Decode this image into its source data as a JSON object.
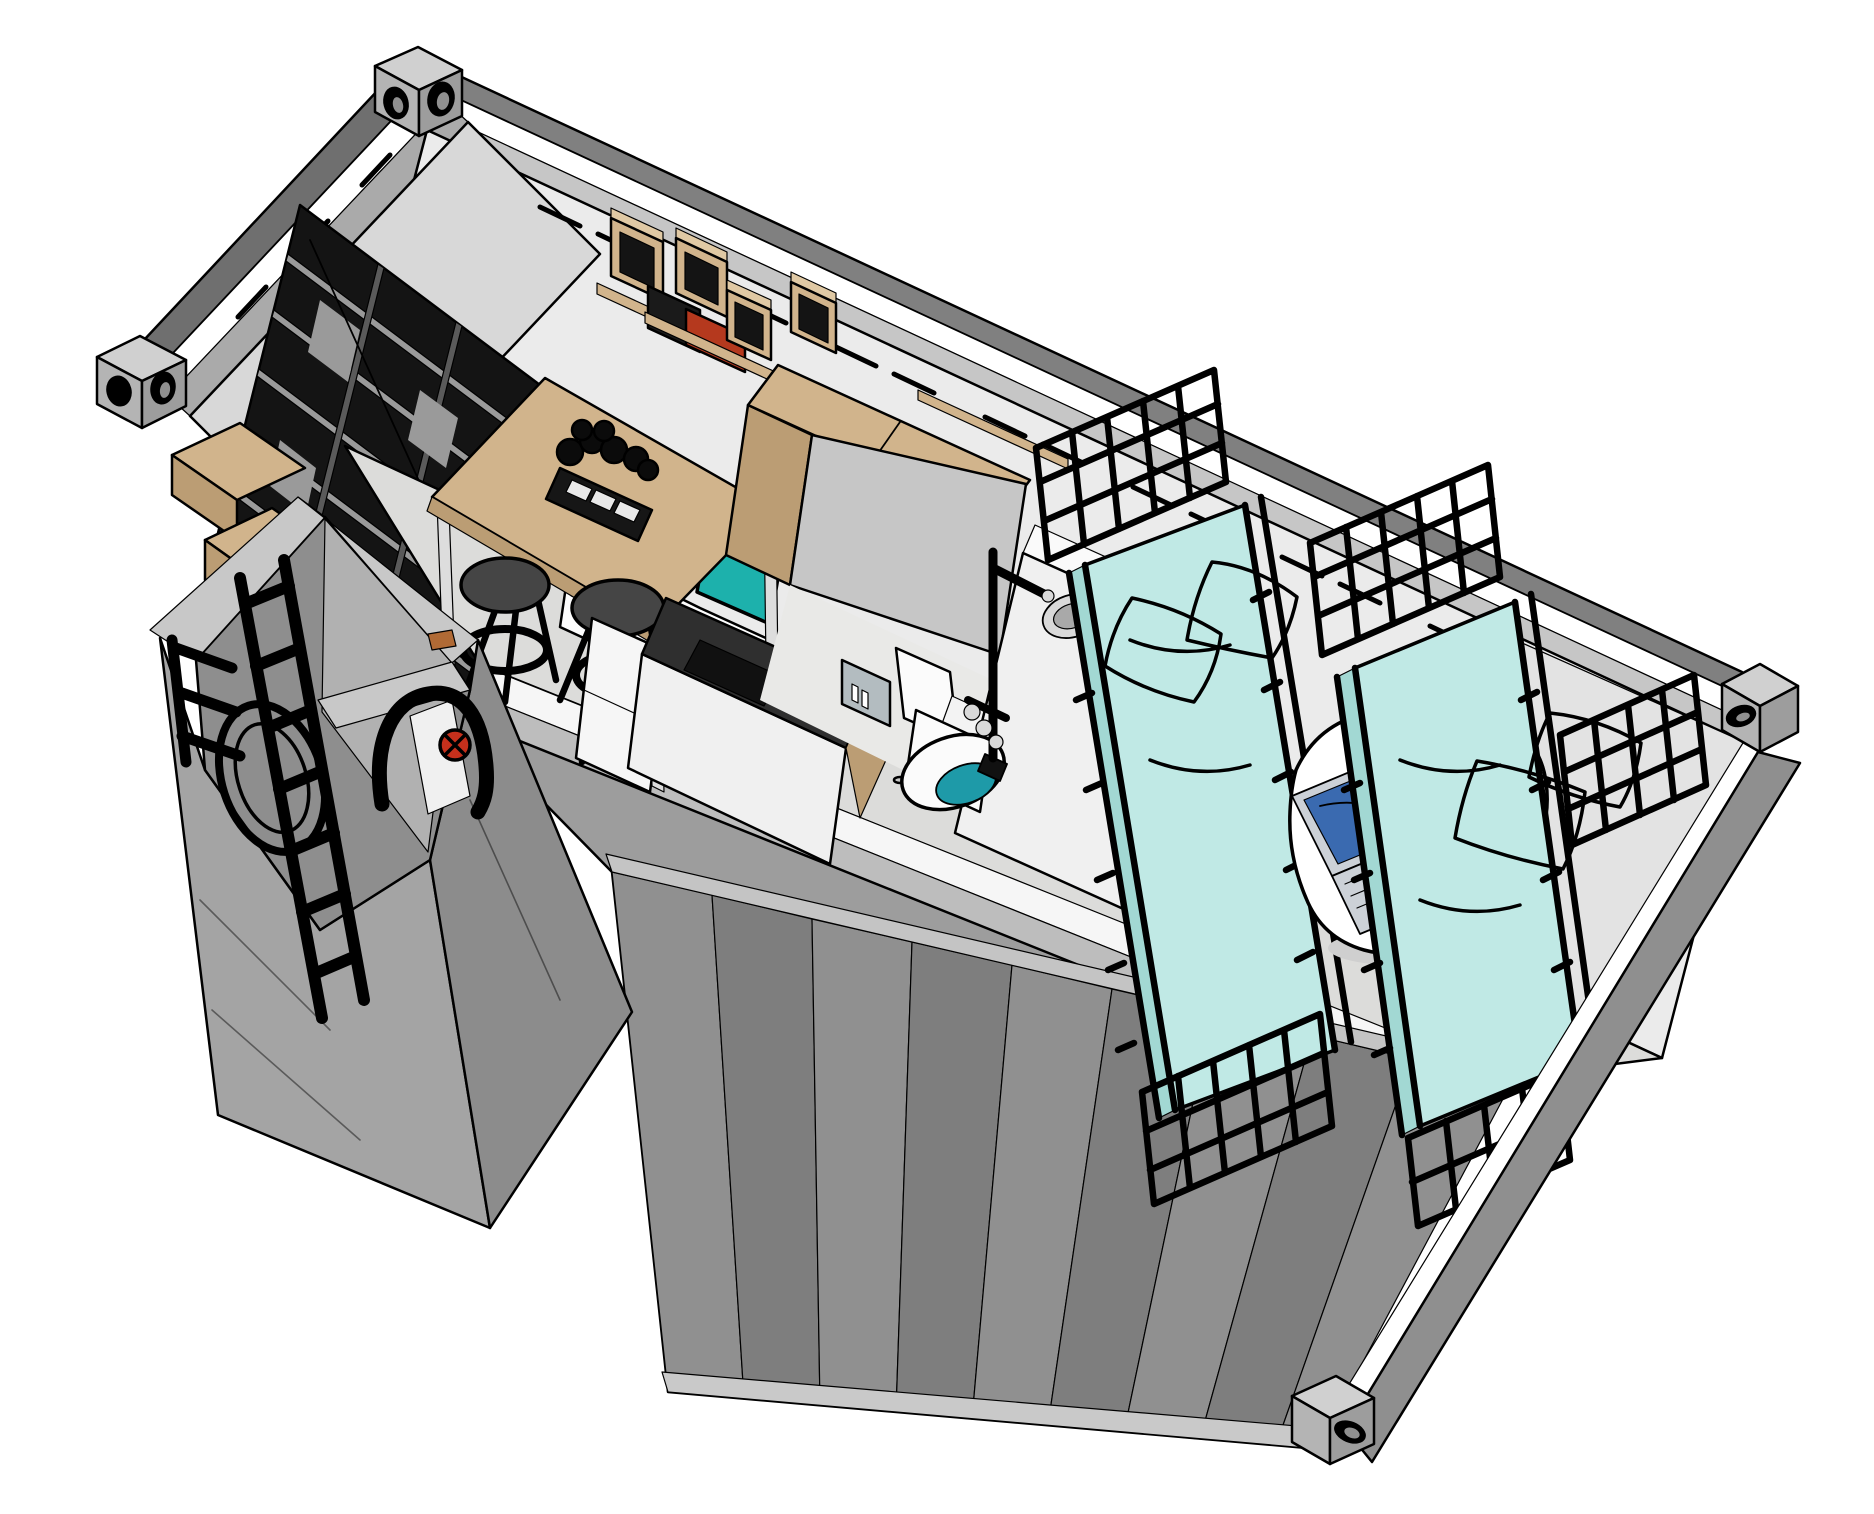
{
  "scene": {
    "type": "3d-isometric-cutaway-render",
    "subject": "shipping-container-tiny-house",
    "rooms": [
      {
        "name": "living-dining"
      },
      {
        "name": "kitchen"
      },
      {
        "name": "bathroom"
      },
      {
        "name": "bedroom"
      },
      {
        "name": "entry-vestibule"
      }
    ],
    "items": [
      "corner-castings",
      "top-rails",
      "vent-slots",
      "black-bookshelf",
      "wall-cube-shelves",
      "wall-shelf-with-books",
      "bench-sofa",
      "teal-throw-pillows",
      "bar-table",
      "planter-centerpiece",
      "bar-stools",
      "kitchen-counter",
      "refrigerator",
      "wooden-wardrobe-cabinet",
      "shower-set",
      "shower-head",
      "mirror-with-toiletries",
      "wall-shelf",
      "toilet",
      "floor-drain",
      "partition-wall",
      "metal-frame-bed-left",
      "metal-frame-bed-right",
      "bed-pillows",
      "white-desk",
      "laptop",
      "black-webcam",
      "entry-vestibule-shaft",
      "access-ladder",
      "hatch-door-frame",
      "red-valve-wheel",
      "entry-wood-shelf",
      "corrugated-side-wall",
      "concrete-floor"
    ]
  },
  "colors": {
    "bg": "#ffffff",
    "ink": "#000000",
    "rail_dark": "#808080",
    "rail_side": "#6f6f6f",
    "white": "#ffffff",
    "chamfer_far": "#c6c6c6",
    "chamfer_left": "#aaaaaa",
    "wall_far": "#ebebeb",
    "wall_left": "#d8d8d8",
    "floor": "#dcdcda",
    "floor_speck": "#c8c8c6",
    "floor_bath": "#e9e9e7",
    "band_white": "#f6f6f6",
    "band_gray": "#bdbdbd",
    "underfloor": "#9d9d9d",
    "corrug_a": "#909090",
    "corrug_b": "#7e7e7e",
    "corrug_top": "#c4c4c4",
    "corrug_bottom": "#c9c9c9",
    "rightwall_band": "#8f8f8f",
    "rightwall_inner": "#e3e3e3",
    "casting_top": "#d0d0d0",
    "casting_a": "#b4b4b4",
    "casting_b": "#9d9d9d",
    "casting_hole_inner": "#909090",
    "vest_rim": "#c8c8c8",
    "vest_cavity": "#8e8e8e",
    "vest_inner": "#b1b1b1",
    "vest_face_a": "#a4a4a4",
    "vest_face_b": "#8c8c8c",
    "hatch_ring": "#d6d6d6",
    "hatch_ring_inner": "#8a8a8a",
    "ladder_white": "#f2f2f2",
    "wood": "#d1b48c",
    "wood_dark": "#bb9d74",
    "wood_light": "#e0c9a4",
    "sill_orange": "#b06a35",
    "shelf_black": "#141414",
    "shelf_board": "#9a9a9a",
    "shelf_divider": "#5a5a5a",
    "glint": "#ffffff",
    "book_dark": "#1a1a1a",
    "book_red": "#b5391e",
    "bench": "#fdfdfd",
    "teal": "#1db1ac",
    "teal_dark": "#149a95",
    "mattress": "#c0e9e5",
    "mattress_side": "#a2d8d3",
    "counter_dark": "#2f2f2f",
    "cooktop": "#111111",
    "cab_white": "#f0f0f0",
    "fridge": "#f6f6f6",
    "partition": "#f0f0f0",
    "partition_top": "#fafafa",
    "mirror": "#b3bcc0",
    "shelf_white": "#fbfbfb",
    "tray": "#f3f3f3",
    "toilet": "#fbfbfb",
    "toilet_teal": "#1e9aa8",
    "drain": "#111111",
    "chrome": "#d9d9d9",
    "chrome_dark": "#a9a9a9",
    "metal_ink": "#111111",
    "frame": "#262626",
    "desk": "#ffffff",
    "desk_shadow": "#cfcfcf",
    "laptop_body": "#ccd1d7",
    "laptop_screen": "#3a6ab0",
    "laptop_keys": "#9aa0a8",
    "obj_black": "#151515",
    "stool": "#454545",
    "stool_ring": "#e5e5e5",
    "leg_dark": "#3a3a3a",
    "leg_light": "#dddddd",
    "plant": "#0b0b0b",
    "planter": "#161616",
    "cup": "#e8e8e8",
    "valve_red": "#c5301c",
    "valve_dark": "#7a1208"
  }
}
